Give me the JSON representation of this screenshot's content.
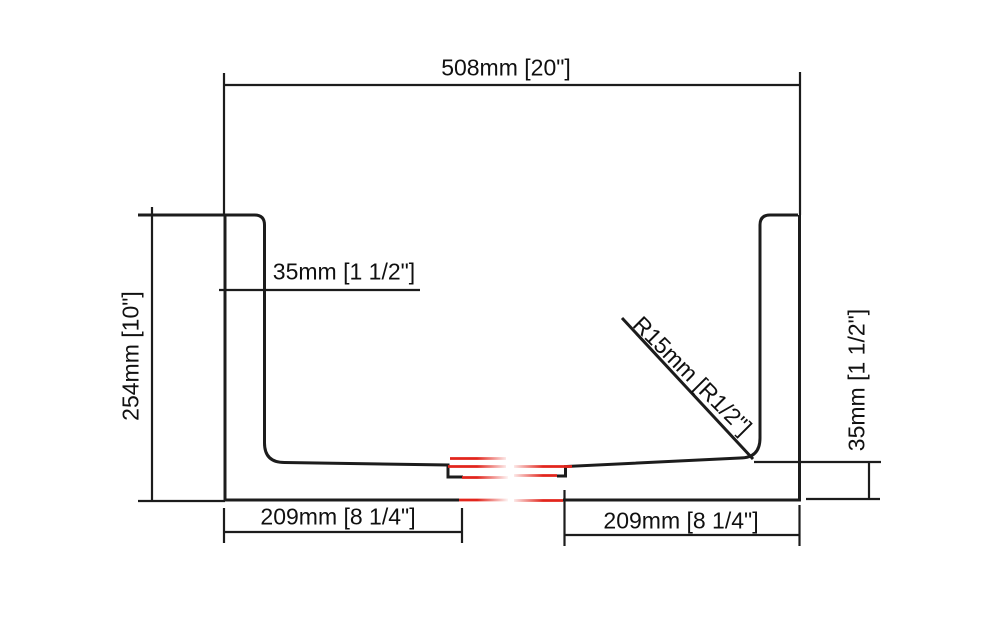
{
  "drawing": {
    "type": "technical-cross-section",
    "labels": {
      "width_overall": "508mm [20\"]",
      "height_overall": "254mm [10\"]",
      "wall_left": "35mm [1 1/2\"]",
      "wall_right": "35mm [1 1/2\"]",
      "corner_radius": "R15mm [R1/2\"]",
      "base_left": "209mm [8 1/4\"]",
      "base_right": "209mm [8 1/4\"]"
    },
    "colors": {
      "line": "#1c1c1c",
      "break_line": "#e2251c",
      "text": "#101010",
      "background": "#ffffff"
    }
  }
}
